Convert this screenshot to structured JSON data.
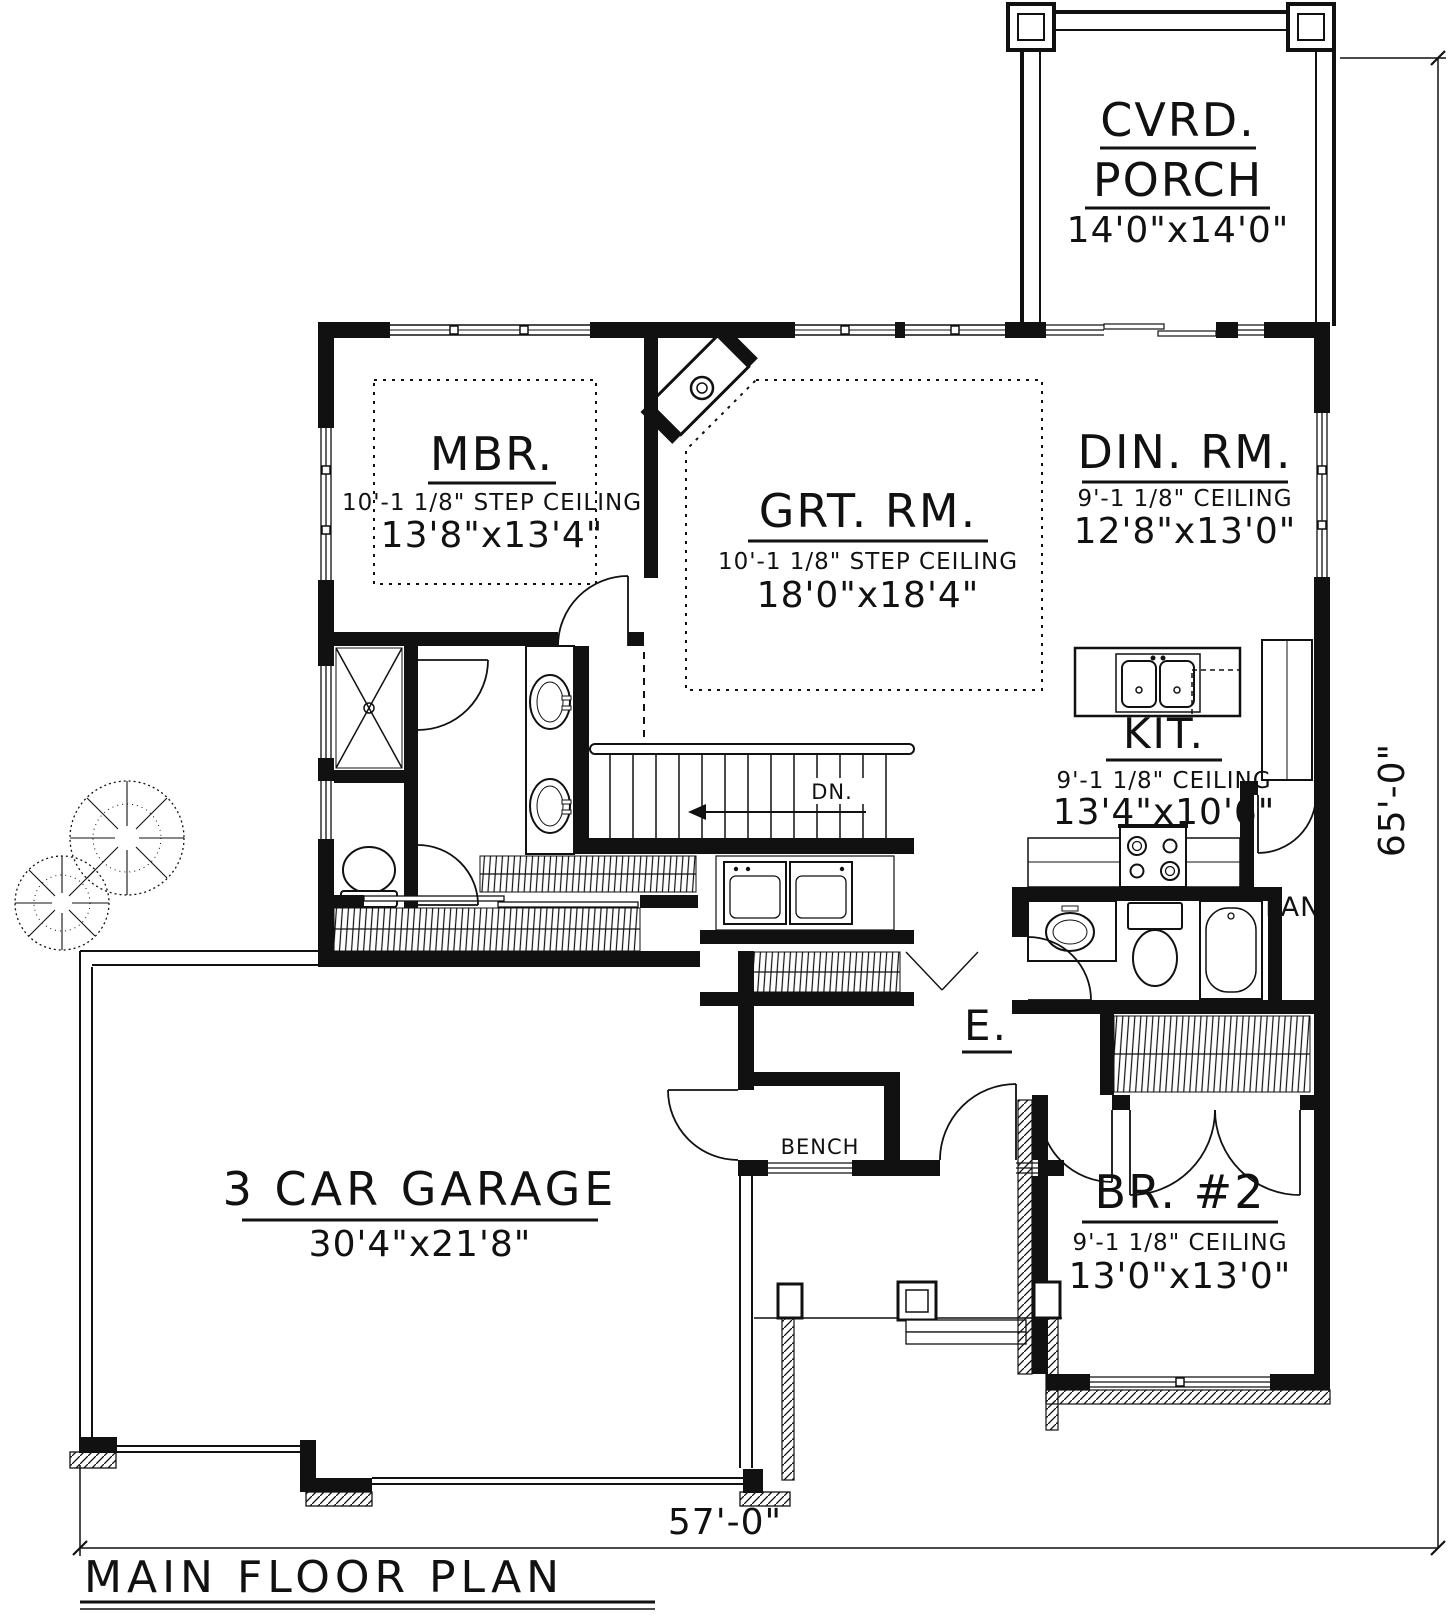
{
  "title": "MAIN FLOOR PLAN",
  "dimensions": {
    "bottom": "57'-0\"",
    "right": "65'-0\""
  },
  "rooms": {
    "porch": {
      "line1": "CVRD.",
      "line2": "PORCH",
      "size": "14'0\"x14'0\""
    },
    "mbr": {
      "name": "MBR.",
      "ceiling": "10'-1 1/8\" STEP CEILING",
      "size": "13'8\"x13'4\""
    },
    "grt": {
      "name": "GRT. RM.",
      "ceiling": "10'-1 1/8\" STEP CEILING",
      "size": "18'0\"x18'4\""
    },
    "din": {
      "name": "DIN. RM.",
      "ceiling": "9'-1 1/8\" CEILING",
      "size": "12'8\"x13'0\""
    },
    "kit": {
      "name": "KIT.",
      "ceiling": "9'-1 1/8\" CEILING",
      "size": "13'4\"x10'6\""
    },
    "pantry": {
      "name": "PAN."
    },
    "entry": {
      "name": "E."
    },
    "bench": {
      "name": "BENCH"
    },
    "stairs": {
      "name": "DN."
    },
    "garage": {
      "name": "3 CAR GARAGE",
      "size": "30'4\"x21'8\""
    },
    "br2": {
      "name": "BR. #2",
      "ceiling": "9'-1 1/8\" CEILING",
      "size": "13'0\"x13'0\""
    }
  },
  "colors": {
    "ink": "#111111",
    "paper": "#ffffff"
  }
}
